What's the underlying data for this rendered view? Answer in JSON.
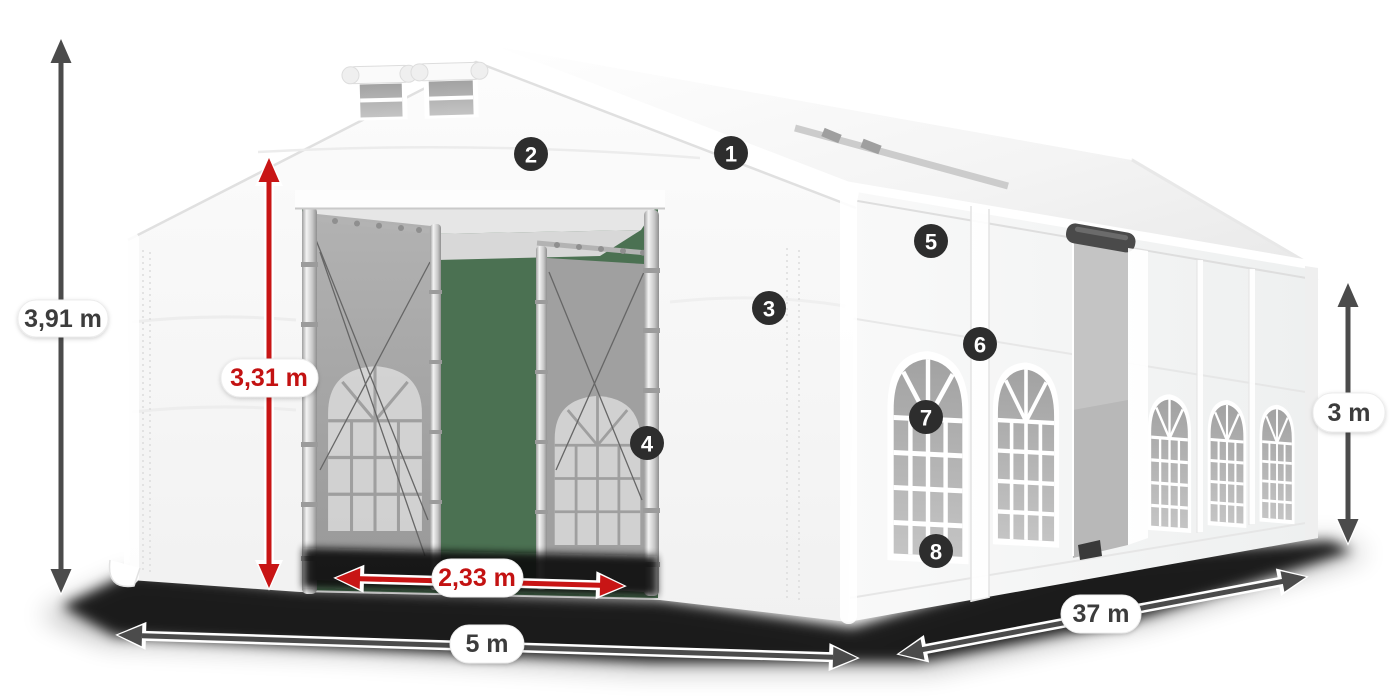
{
  "diagram": {
    "subject": "party-tent-dimension-diagram",
    "colors": {
      "accent_red": "#c81515",
      "dimension_gray": "#4b4b4b",
      "badge_background": "#2d2d2d",
      "opening_green": "#4b7152",
      "canvas": "#ffffff"
    },
    "measurements": {
      "total_height": "3,91 m",
      "entrance_height": "3,31 m",
      "entrance_width": "2,33 m",
      "front_width": "5 m",
      "length": "37 m",
      "side_wall_height": "3 m"
    },
    "callouts": [
      "1",
      "2",
      "3",
      "4",
      "5",
      "6",
      "7",
      "8"
    ]
  }
}
